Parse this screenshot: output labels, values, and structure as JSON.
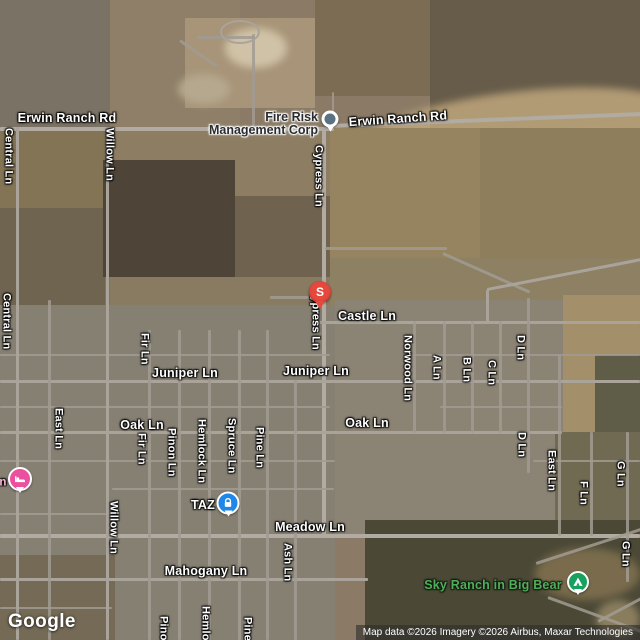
{
  "streets": {
    "erwin_w": "Erwin Ranch Rd",
    "erwin_e": "Erwin Ranch Rd",
    "central_n": "Central Ln",
    "central_s": "Central Ln",
    "willow_n": "Willow Ln",
    "willow_s": "Willow Ln",
    "cypress_n": "Cypress Ln",
    "cypress_s": "Cypress Ln",
    "castle": "Castle Ln",
    "juniper_w": "Juniper Ln",
    "juniper_e": "Juniper Ln",
    "oak_w": "Oak Ln",
    "oak_e": "Oak Ln",
    "meadow": "Meadow Ln",
    "mahogany": "Mahogany Ln",
    "east_w": "East Ln",
    "east_e": "East Ln",
    "fir_n": "Fir Ln",
    "fir_s": "Fir Ln",
    "pinon": "Pinon Ln",
    "pinon_b": "Pinon Ln",
    "hemlock": "Hemlock Ln",
    "hemlock_b": "Hemlock Ln",
    "spruce": "Spruce Ln",
    "pine": "Pine Ln",
    "pine_b": "Pine Ln",
    "ash": "Ash Ln",
    "norwood": "Norwood Ln",
    "a_ln": "A Ln",
    "b_ln": "B Ln",
    "c_ln": "C Ln",
    "d_n": "D Ln",
    "d_s": "D Ln",
    "f_ln": "F Ln",
    "g_n": "G Ln",
    "g_s": "G Ln"
  },
  "pois": {
    "fire_risk": {
      "name": "Fire Risk Management Corp",
      "line1": "Fire Risk",
      "line2": "Management Corp",
      "icon": "generic-place-pin-icon"
    },
    "s_place": {
      "glyph": "S",
      "icon": "red-pin-icon"
    },
    "taz": {
      "label": "TAZ",
      "icon": "padlock-icon"
    },
    "lodging": {
      "partial_label": "n",
      "icon": "bed-icon"
    },
    "sky_ranch": {
      "label": "Sky Ranch in Big Bear",
      "icon": "campground-icon"
    }
  },
  "attribution": {
    "logo": "Google",
    "copyright": "Map data ©2026 Imagery ©2026 Airbus, Maxar Technologies"
  },
  "colors": {
    "road": "#a9a39a",
    "red_pin": "#e5493d",
    "blue_marker": "#1f87e8",
    "pink_marker": "#ec4f9e",
    "green_marker": "#16a15e",
    "generic_pin_dot": "#5b7282",
    "park_label_green": "#4fae58",
    "street_label": "#ffffff",
    "poi_label_dark": "#2b2c30"
  }
}
